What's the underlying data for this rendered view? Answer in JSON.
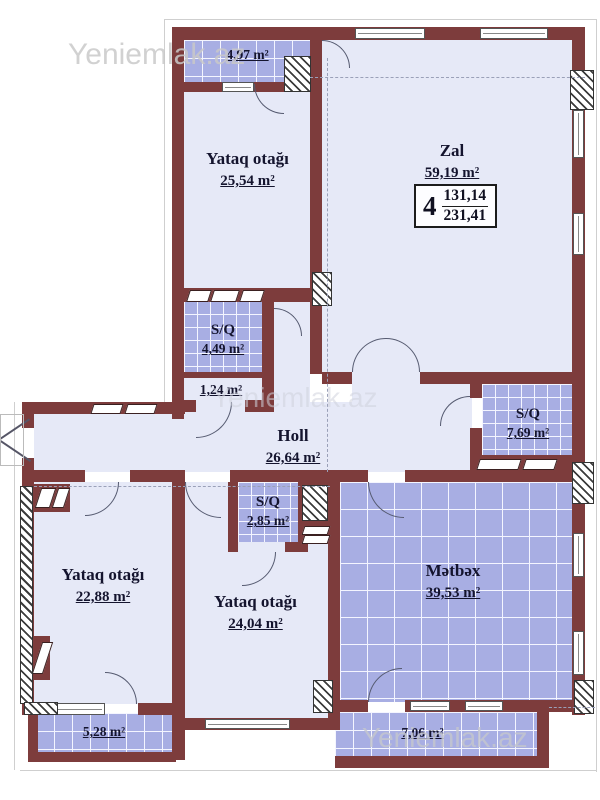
{
  "watermarks": {
    "top": "Yeniemlak.az",
    "middle": "Yeniemlak.az",
    "bottom": "Yeniemlak.az"
  },
  "unit_info": {
    "room_count": "4",
    "value_top": "131,14",
    "value_bottom": "231,41"
  },
  "rooms": [
    {
      "id": "balcony-top",
      "name": "",
      "area": "4,97 m²"
    },
    {
      "id": "bedroom-top",
      "name": "Yataq otağı",
      "area": "25,54 m²"
    },
    {
      "id": "zal",
      "name": "Zal",
      "area": "59,19 m²"
    },
    {
      "id": "sq-449",
      "name": "S/Q",
      "area": "4,49 m²"
    },
    {
      "id": "corridor-124",
      "name": "",
      "area": "1,24 m²"
    },
    {
      "id": "holl",
      "name": "Holl",
      "area": "26,64 m²"
    },
    {
      "id": "sq-769",
      "name": "S/Q",
      "area": "7,69 m²"
    },
    {
      "id": "sq-285",
      "name": "S/Q",
      "area": "2,85 m²"
    },
    {
      "id": "bedroom-left",
      "name": "Yataq otağı",
      "area": "22,88 m²"
    },
    {
      "id": "bedroom-mid",
      "name": "Yataq otağı",
      "area": "24,04 m²"
    },
    {
      "id": "kitchen",
      "name": "Mətbəx",
      "area": "39,53 m²"
    },
    {
      "id": "balcony-left",
      "name": "",
      "area": "5,28 m²"
    },
    {
      "id": "balcony-right",
      "name": "",
      "area": "7,06 m²"
    }
  ],
  "colors": {
    "wall": "#7d3c3c",
    "floor": "#e6e9f7",
    "tile": "#a8aee3",
    "text": "#14142e",
    "watermark": "#c9c9c9"
  }
}
